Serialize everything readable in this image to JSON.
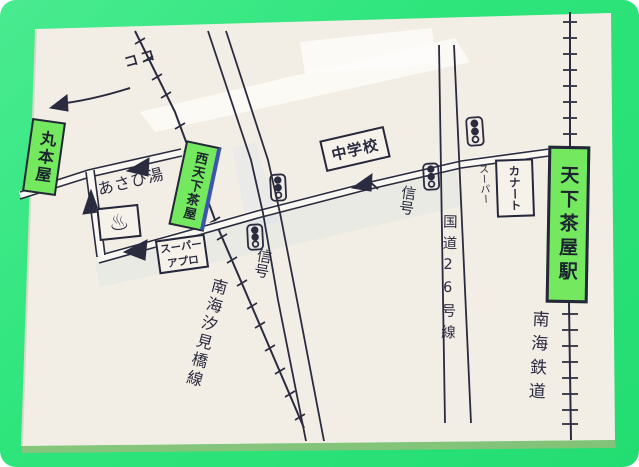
{
  "meta": {
    "kind": "hand-drawn direction map photo (Japanese), green mat frame",
    "frame_color": "#2ee57c",
    "paper_color": "#f3eee5",
    "ink_color": "#2b2b40",
    "highlight_green": "#74e85f"
  },
  "labels": {
    "here_pointer": "ココ",
    "marumotoya": "丸本屋",
    "asahiyu": "あさひ湯",
    "onsen_mark": "♨",
    "nishi_tengachaya": "西天下茶屋",
    "super_apro_line1": "スーパー",
    "super_apro_line2": "アプロ",
    "junior_high": "中学校",
    "signal_1": "信号",
    "signal_2": "信号",
    "kanato": "カナート",
    "kanato_super": "スーパー",
    "tengachaya_station": "天下茶屋駅",
    "route26": "国道26号線",
    "nankai_railway": "南海鉄道",
    "nankai_shiomibashi_line": "南海汐見橋線"
  }
}
